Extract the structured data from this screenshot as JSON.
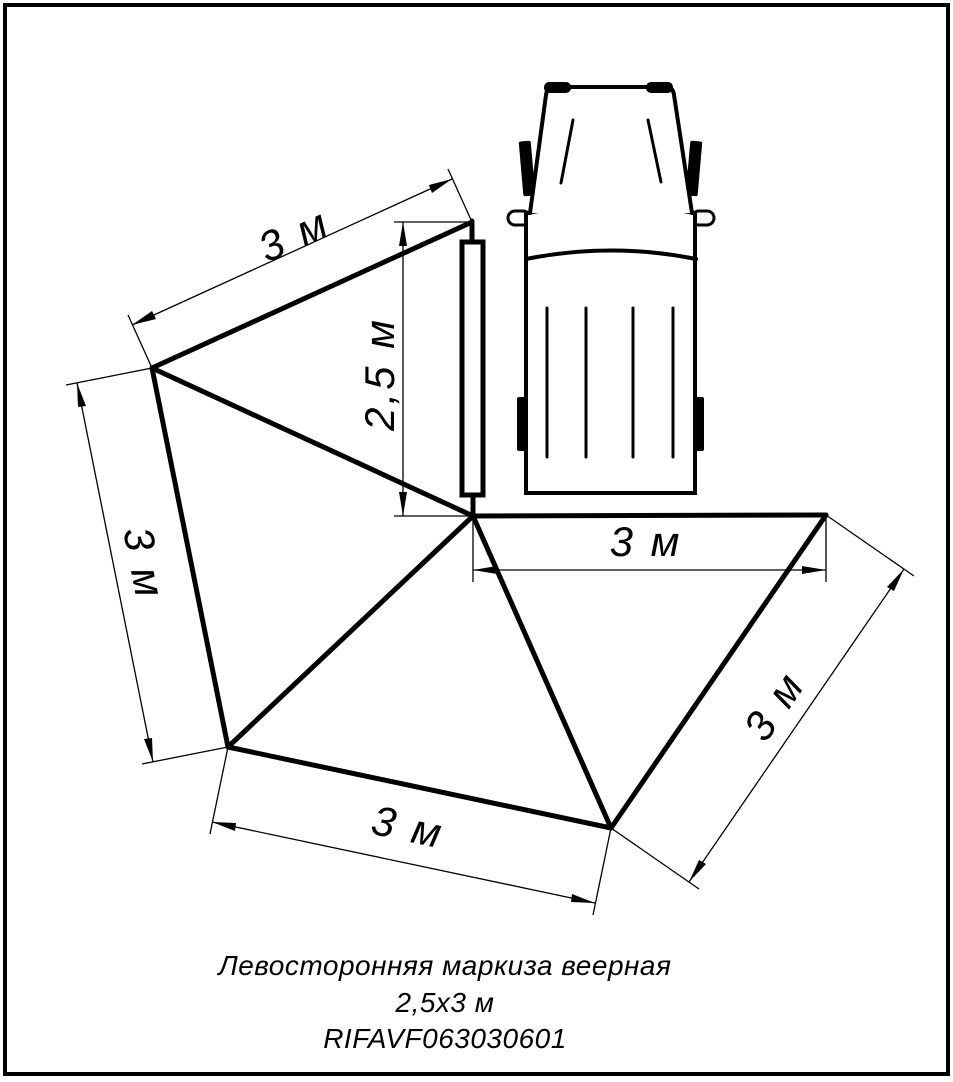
{
  "dimensions": {
    "top": {
      "label": "3 м"
    },
    "height": {
      "label": "2,5 м"
    },
    "left": {
      "label": "3 м"
    },
    "bottom": {
      "label": "3 м"
    },
    "inner_horizontal": {
      "label": "3 м"
    },
    "right": {
      "label": "3 м"
    }
  },
  "title": {
    "line1": "Левосторонняя маркиза веерная",
    "line2": "2,5х3 м",
    "line3": "RIFAVF063030601"
  },
  "colors": {
    "ink": "#000000",
    "paper": "#ffffff"
  }
}
